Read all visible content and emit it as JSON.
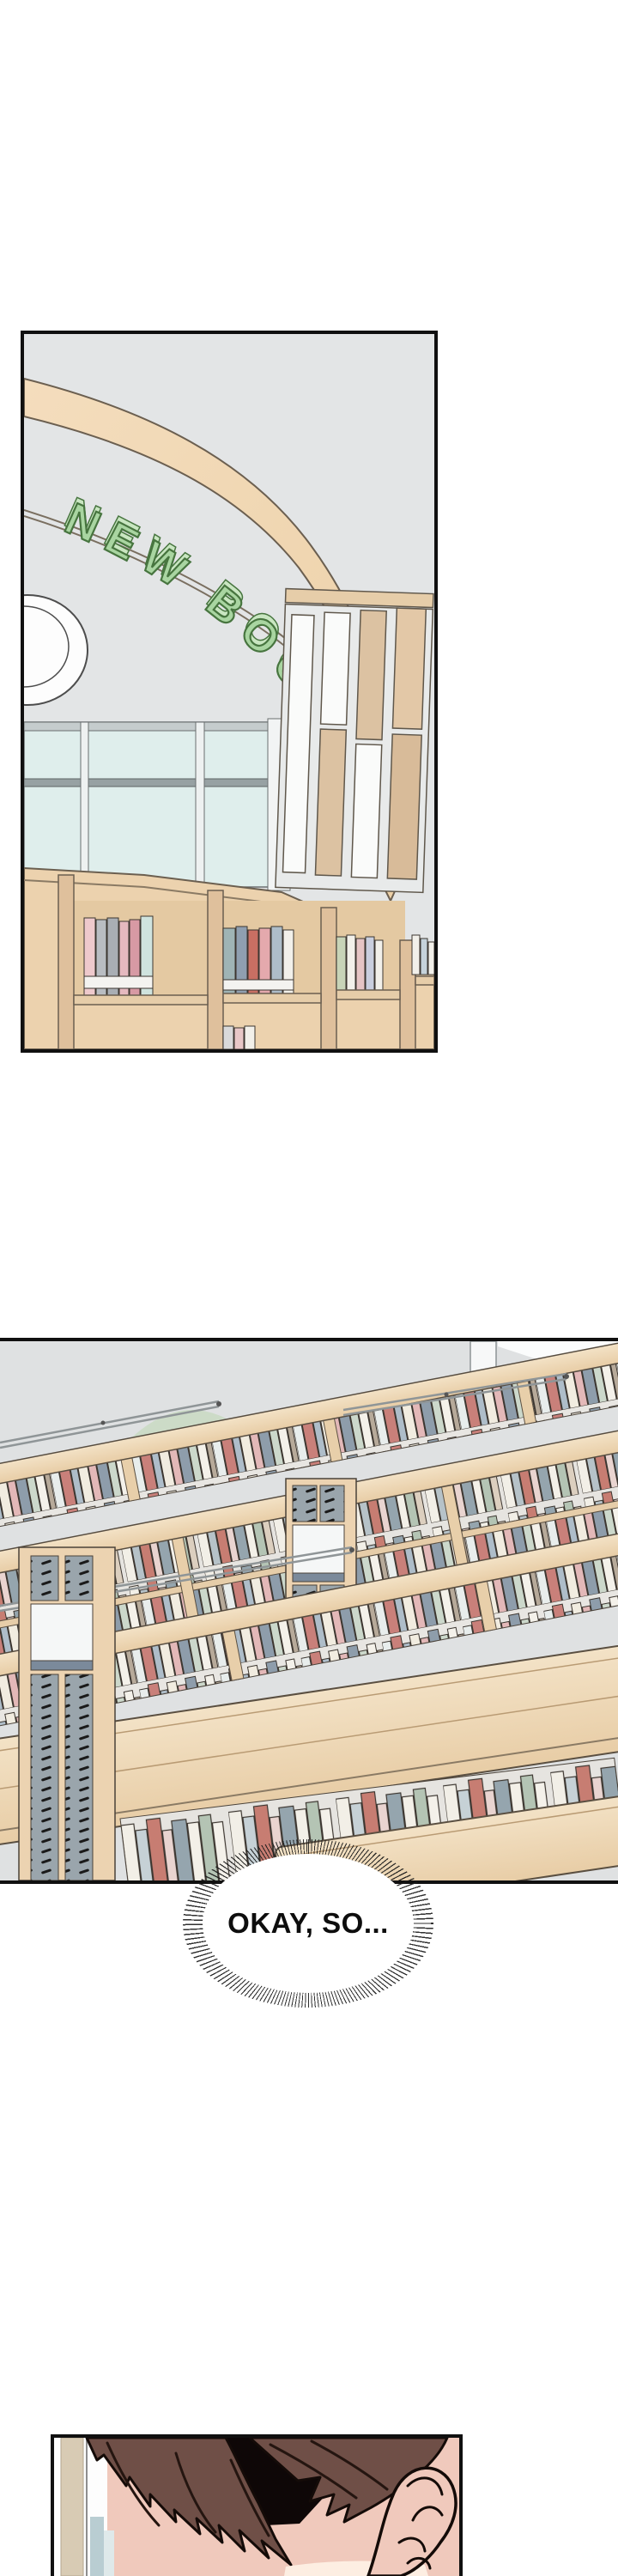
{
  "page": {
    "background": "#ffffff",
    "type": "comic-page"
  },
  "panel1": {
    "name": "library-entrance-new-book-corner",
    "sign_text": "NEW BOOK",
    "colors": {
      "background": "#e3e5e6",
      "wood_band": "#f1d7b4",
      "wood_shelf": "#ecd2ae",
      "wood_dark": "#dfc09c",
      "sign_green": "#a9d5a1",
      "sign_green_light": "#c9e6c1",
      "sign_green_dark": "#47753f",
      "glass": "#dfeeec",
      "mullion": "#97a1a3",
      "outline": "#6b5f50"
    }
  },
  "panel2": {
    "name": "library-stacks-overview",
    "colors": {
      "background": "#dfe1e2",
      "wood_top": "#eed7b6",
      "wood_face": "#e9d0ab",
      "dome_green": "#ccdbc7",
      "perforated_gray": "#9aa5ac",
      "rail_gray": "#9aa0a2",
      "book_red": "#c77d72",
      "book_bluegray": "#95a5ae",
      "book_sage": "#b4c4b4",
      "book_cream": "#f2efe7"
    }
  },
  "bubble": {
    "text": "OKAY, SO..."
  },
  "panel3": {
    "name": "head-closeup",
    "colors": {
      "hair": "#6f4f47",
      "hair_shadow": "#0e0707",
      "skin": "#f0c9bc",
      "skin_highlight": "#fdeee2",
      "bg_beige": "#d8cbb4",
      "bg_blue": "#b9cdd2"
    }
  }
}
